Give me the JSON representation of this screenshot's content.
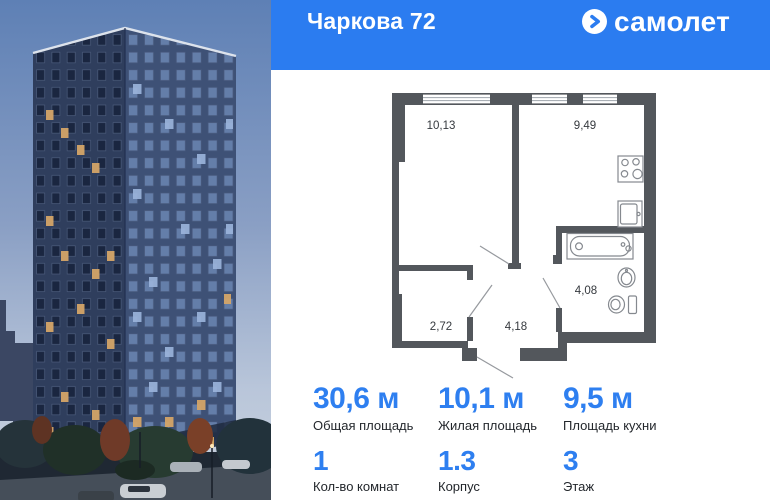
{
  "header": {
    "title": "Чаркова 72",
    "logo": {
      "text": "самолет",
      "icon": "arrow-right-circle"
    },
    "bg_color": "#2b7cf0",
    "text_color": "#ffffff"
  },
  "floor_plan": {
    "wall_color": "#53575c",
    "rooms": [
      {
        "id": "living-room",
        "area": "10,13"
      },
      {
        "id": "kitchen",
        "area": "9,49"
      },
      {
        "id": "bathroom",
        "area": "4,08"
      },
      {
        "id": "storage",
        "area": "2,72"
      },
      {
        "id": "hallway",
        "area": "4,18"
      }
    ],
    "fixtures": [
      "stove",
      "kitchen-sink",
      "bathtub",
      "wash-basin",
      "toilet"
    ]
  },
  "stats": {
    "accent_color": "#2e7ff0",
    "primary": [
      {
        "value": "30,6 м",
        "label": "Общая площадь"
      },
      {
        "value": "10,1 м",
        "label": "Жилая площадь"
      },
      {
        "value": "9,5 м",
        "label": "Площадь кухни"
      }
    ],
    "secondary": [
      {
        "value": "1",
        "label": "Кол-во комнат"
      },
      {
        "value": "1.3",
        "label": "Корпус"
      },
      {
        "value": "3",
        "label": "Этаж"
      }
    ]
  }
}
